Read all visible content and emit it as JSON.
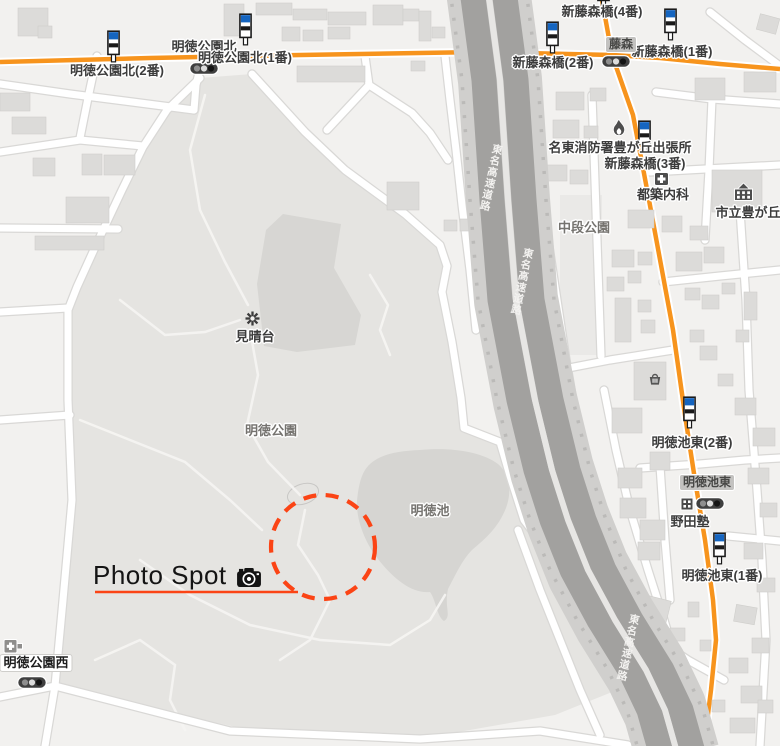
{
  "colors": {
    "background": "#f2f1ef",
    "park": "#e5e4e1",
    "park_dark": "#d7d6d3",
    "pond": "#d6d5d2",
    "building": "#dcdbd9",
    "road_casing": "#d9d8d6",
    "road_orange": "#f7941d",
    "highway_dark": "#a2a19f",
    "highway_shoulder": "#d0cfcd",
    "bus_icon_blue": "#1565c0",
    "annotation_red": "#fb4415",
    "label_text": "#3c3c3c",
    "area_label_text": "#75736f"
  },
  "map": {
    "bus_stops": [
      {
        "label": "明徳公園北(2番)",
        "icon": {
          "x": 107,
          "y": 30
        },
        "label_pos": {
          "x": 117,
          "y": 64
        }
      },
      {
        "label": "明徳公園北",
        "icon": null,
        "label_pos": {
          "x": 204,
          "y": 40
        }
      },
      {
        "label": "明徳公園北(1番)",
        "icon": {
          "x": 239,
          "y": 13
        },
        "label_pos": {
          "x": 245,
          "y": 51
        }
      },
      {
        "label": "新藤森橋(4番)",
        "icon": {
          "x": 597,
          "y": -24
        },
        "label_pos": {
          "x": 602,
          "y": 5
        }
      },
      {
        "label": "新藤森橋(2番)",
        "icon": {
          "x": 546,
          "y": 21
        },
        "label_pos": {
          "x": 553,
          "y": 56
        }
      },
      {
        "label": "新藤森橋(1番)",
        "icon": {
          "x": 664,
          "y": 8
        },
        "label_pos": {
          "x": 672,
          "y": 45
        }
      },
      {
        "label": "新藤森橋(3番)",
        "icon": {
          "x": 638,
          "y": 120
        },
        "label_pos": {
          "x": 645,
          "y": 157
        }
      },
      {
        "label": "明徳池東(2番)",
        "icon": {
          "x": 683,
          "y": 396
        },
        "label_pos": {
          "x": 692,
          "y": 436
        }
      },
      {
        "label": "明徳池東(1番)",
        "icon": {
          "x": 713,
          "y": 532
        },
        "label_pos": {
          "x": 722,
          "y": 569
        }
      }
    ],
    "pois": [
      {
        "label": "名東消防署豊が丘出張所",
        "icon": "fire-icon",
        "icon_pos": {
          "x": 611,
          "y": 119
        },
        "label_pos": {
          "x": 620,
          "y": 141
        },
        "class": "poi"
      },
      {
        "label": "都築内科",
        "icon": "clinic-icon",
        "icon_pos": {
          "x": 654,
          "y": 172
        },
        "label_pos": {
          "x": 663,
          "y": 188
        },
        "class": "poi"
      },
      {
        "label": "市立豊が丘",
        "icon": "school-icon",
        "icon_pos": {
          "x": 733,
          "y": 182
        },
        "label_pos": {
          "x": 748,
          "y": 206
        },
        "class": "poi"
      },
      {
        "label": "野田塾",
        "icon": "building-icon",
        "icon_pos": {
          "x": 680,
          "y": 497
        },
        "label_pos": {
          "x": 690,
          "y": 515
        },
        "class": "poi"
      },
      {
        "label": "見晴台",
        "icon": "viewpoint-icon",
        "icon_pos": {
          "x": 244,
          "y": 310
        },
        "label_pos": {
          "x": 255,
          "y": 330
        },
        "class": "poi"
      },
      {
        "label": "中段公園",
        "icon": null,
        "label_pos": {
          "x": 584,
          "y": 221
        },
        "class": "area"
      },
      {
        "label": "明徳公園",
        "icon": null,
        "label_pos": {
          "x": 271,
          "y": 424
        },
        "class": "area"
      },
      {
        "label": "明徳池",
        "icon": null,
        "label_pos": {
          "x": 430,
          "y": 504
        },
        "class": "area"
      },
      {
        "label": null,
        "icon": "store-icon",
        "icon_pos": {
          "x": 648,
          "y": 372
        }
      },
      {
        "label": null,
        "icon": "hospital-icon",
        "icon_pos": {
          "x": 3,
          "y": 637
        }
      }
    ],
    "intersections": [
      {
        "label": "藤森",
        "style": "gray",
        "pos": {
          "x": 621,
          "y": 37
        }
      },
      {
        "label": "明徳池東",
        "style": "gray",
        "pos": {
          "x": 707,
          "y": 475
        }
      },
      {
        "label": "明徳公園西",
        "style": "white",
        "pos": {
          "x": 36,
          "y": 655
        }
      }
    ],
    "signals": [
      {
        "x": 189,
        "y": 62
      },
      {
        "x": 601,
        "y": 55
      },
      {
        "x": 695,
        "y": 497
      },
      {
        "x": 17,
        "y": 676
      }
    ],
    "highway_name": "東名高速道路",
    "highway_labels": [
      {
        "x": 490,
        "y": 143
      },
      {
        "x": 521,
        "y": 247
      },
      {
        "x": 627,
        "y": 613
      }
    ],
    "annotation": {
      "label": "Photo Spot",
      "icon": "camera-icon"
    }
  }
}
